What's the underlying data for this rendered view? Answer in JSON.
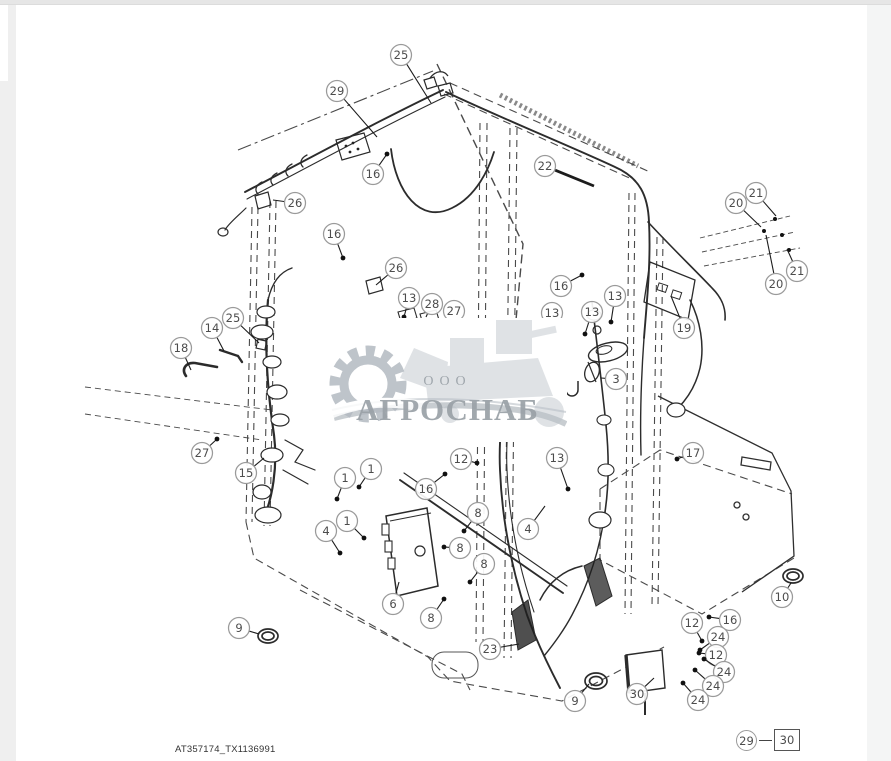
{
  "caption": "AT357174_TX1136991",
  "watermark": {
    "ooo": "ООО",
    "name": "АГРОСНАБ"
  },
  "legend": {
    "left": "29",
    "right": "30"
  },
  "colors": {
    "line": "#2f2f2f",
    "dashed": "#464646",
    "balloon_stroke": "#9a9a9a",
    "balloon_text": "#4c4c4c",
    "leader": "#1c1c1c",
    "watermark_gray": "#9aa1a7"
  },
  "callouts": [
    {
      "n": "25",
      "x": 401,
      "y": 55,
      "tx": 431,
      "ty": 103
    },
    {
      "n": "29",
      "x": 337,
      "y": 91,
      "tx": 377,
      "ty": 137
    },
    {
      "n": "16",
      "x": 373,
      "y": 174,
      "tx": 387,
      "ty": 154,
      "b": 1
    },
    {
      "n": "26",
      "x": 295,
      "y": 203,
      "tx": 273,
      "ty": 200
    },
    {
      "n": "16",
      "x": 334,
      "y": 234,
      "tx": 343,
      "ty": 258,
      "b": 1
    },
    {
      "n": "26",
      "x": 396,
      "y": 268,
      "tx": 376,
      "ty": 285
    },
    {
      "n": "22",
      "x": 545,
      "y": 166,
      "tx": 594,
      "ty": 186,
      "w": 1
    },
    {
      "n": "20",
      "x": 736,
      "y": 203,
      "tx": 761,
      "ty": 227
    },
    {
      "n": "21",
      "x": 756,
      "y": 193,
      "tx": 776,
      "ty": 216
    },
    {
      "n": "21",
      "x": 797,
      "y": 271,
      "tx": 787,
      "ty": 249
    },
    {
      "n": "20",
      "x": 776,
      "y": 284,
      "tx": 766,
      "ty": 235
    },
    {
      "n": "19",
      "x": 684,
      "y": 328,
      "tx": 671,
      "ty": 296
    },
    {
      "n": "13",
      "x": 409,
      "y": 298,
      "tx": 404,
      "ty": 317,
      "b": 1
    },
    {
      "n": "28",
      "x": 432,
      "y": 304,
      "tx": 426,
      "ty": 317
    },
    {
      "n": "27",
      "x": 454,
      "y": 311,
      "tx": 447,
      "ty": 325
    },
    {
      "n": "16",
      "x": 561,
      "y": 286,
      "tx": 582,
      "ty": 275,
      "b": 1
    },
    {
      "n": "13",
      "x": 552,
      "y": 313,
      "tx": 558,
      "ty": 336,
      "b": 1
    },
    {
      "n": "13",
      "x": 592,
      "y": 312,
      "tx": 585,
      "ty": 334,
      "b": 1
    },
    {
      "n": "13",
      "x": 615,
      "y": 296,
      "tx": 611,
      "ty": 322,
      "b": 1
    },
    {
      "n": "3",
      "x": 616,
      "y": 379,
      "tx": 601,
      "ty": 378
    },
    {
      "n": "14",
      "x": 212,
      "y": 328,
      "tx": 224,
      "ty": 351
    },
    {
      "n": "25",
      "x": 233,
      "y": 318,
      "tx": 259,
      "ty": 343
    },
    {
      "n": "18",
      "x": 181,
      "y": 348,
      "tx": 191,
      "ty": 370
    },
    {
      "n": "27",
      "x": 202,
      "y": 453,
      "tx": 217,
      "ty": 439,
      "b": 1
    },
    {
      "n": "15",
      "x": 246,
      "y": 473,
      "tx": 264,
      "ty": 458
    },
    {
      "n": "1",
      "x": 345,
      "y": 478,
      "tx": 337,
      "ty": 499,
      "b": 1
    },
    {
      "n": "1",
      "x": 371,
      "y": 469,
      "tx": 359,
      "ty": 487,
      "b": 1
    },
    {
      "n": "1",
      "x": 347,
      "y": 521,
      "tx": 364,
      "ty": 538,
      "b": 1
    },
    {
      "n": "4",
      "x": 326,
      "y": 531,
      "tx": 340,
      "ty": 553,
      "b": 1
    },
    {
      "n": "12",
      "x": 461,
      "y": 459,
      "tx": 477,
      "ty": 463,
      "b": 1
    },
    {
      "n": "16",
      "x": 426,
      "y": 489,
      "tx": 445,
      "ty": 474,
      "b": 1
    },
    {
      "n": "13",
      "x": 557,
      "y": 458,
      "tx": 568,
      "ty": 489,
      "b": 1
    },
    {
      "n": "17",
      "x": 693,
      "y": 453,
      "tx": 677,
      "ty": 459,
      "b": 1
    },
    {
      "n": "4",
      "x": 528,
      "y": 529,
      "tx": 545,
      "ty": 506
    },
    {
      "n": "8",
      "x": 478,
      "y": 513,
      "tx": 464,
      "ty": 531,
      "b": 1
    },
    {
      "n": "8",
      "x": 460,
      "y": 548,
      "tx": 444,
      "ty": 547,
      "b": 1
    },
    {
      "n": "8",
      "x": 484,
      "y": 564,
      "tx": 470,
      "ty": 582,
      "b": 1
    },
    {
      "n": "8",
      "x": 431,
      "y": 618,
      "tx": 444,
      "ty": 599,
      "b": 1
    },
    {
      "n": "6",
      "x": 393,
      "y": 604,
      "tx": 399,
      "ty": 582
    },
    {
      "n": "23",
      "x": 490,
      "y": 649,
      "tx": 519,
      "ty": 644
    },
    {
      "n": "9",
      "x": 239,
      "y": 628,
      "tx": 259,
      "ty": 634
    },
    {
      "n": "9",
      "x": 575,
      "y": 701,
      "tx": 589,
      "ty": 684
    },
    {
      "n": "10",
      "x": 782,
      "y": 597,
      "tx": 791,
      "ty": 583
    },
    {
      "n": "30",
      "x": 637,
      "y": 694,
      "tx": 654,
      "ty": 678
    },
    {
      "n": "12",
      "x": 692,
      "y": 623,
      "tx": 702,
      "ty": 641,
      "b": 1
    },
    {
      "n": "16",
      "x": 730,
      "y": 620,
      "tx": 709,
      "ty": 617,
      "b": 1
    },
    {
      "n": "24",
      "x": 718,
      "y": 637,
      "tx": 700,
      "ty": 650,
      "b": 1
    },
    {
      "n": "12",
      "x": 716,
      "y": 655,
      "tx": 699,
      "ty": 653,
      "b": 1
    },
    {
      "n": "24",
      "x": 724,
      "y": 672,
      "tx": 704,
      "ty": 659,
      "b": 1
    },
    {
      "n": "24",
      "x": 713,
      "y": 686,
      "tx": 695,
      "ty": 670,
      "b": 1
    },
    {
      "n": "24",
      "x": 698,
      "y": 700,
      "tx": 683,
      "ty": 683,
      "b": 1
    }
  ]
}
